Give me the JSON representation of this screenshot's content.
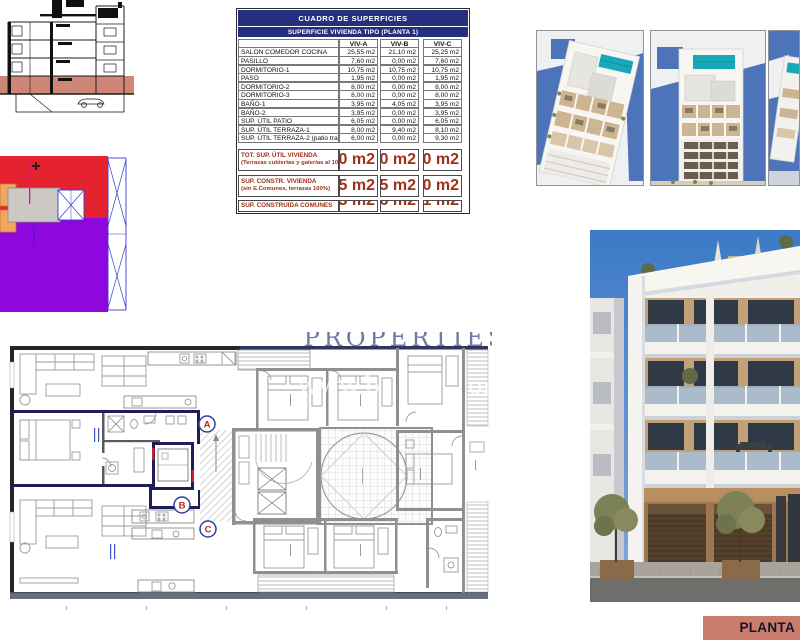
{
  "surface_table": {
    "title": "CUADRO DE SUPERFICIES",
    "subtitle": "SUPERFICIE VIVIENDA TIPO  (PLANTA 1)",
    "unit_columns": [
      "VIV-A",
      "VIV-B",
      "VIV-C"
    ],
    "rows": [
      {
        "label": "SALON COMEDOR COCINA",
        "values": [
          "25,55 m2",
          "21,10 m2",
          "25,25 m2"
        ]
      },
      {
        "label": "PASILLO",
        "values": [
          "7,60 m2",
          "0,00 m2",
          "7,60 m2"
        ]
      },
      {
        "label": "DORMITORIO-1",
        "values": [
          "10,75 m2",
          "10,75 m2",
          "10,75 m2"
        ]
      },
      {
        "label": "PASO",
        "values": [
          "1,95 m2",
          "0,00 m2",
          "1,95 m2"
        ]
      },
      {
        "label": "DORMITORIO-2",
        "values": [
          "8,00 m2",
          "0,00 m2",
          "8,00 m2"
        ]
      },
      {
        "label": "DORMITORIO-3",
        "values": [
          "8,00 m2",
          "0,00 m2",
          "8,00 m2"
        ]
      },
      {
        "label": "BAÑO-1",
        "values": [
          "3,95 m2",
          "4,05 m2",
          "3,95 m2"
        ]
      },
      {
        "label": "BAÑO-2",
        "values": [
          "3,95 m2",
          "0,00 m2",
          "3,95 m2"
        ]
      },
      {
        "label": "SUP. ÚTIL PATIO",
        "values": [
          "6,05 m2",
          "0,00 m2",
          "6,05 m2"
        ]
      },
      {
        "label": "SUP. ÚTIL TERRAZA-1",
        "values": [
          "8,00 m2",
          "9,40 m2",
          "8,10 m2"
        ]
      },
      {
        "label": "SUP. ÚTIL TERRAZA-2 (patio trasero)",
        "values": [
          "6,00 m2",
          "0,00 m2",
          "9,30 m2"
        ]
      }
    ],
    "summary_rows": [
      {
        "label": "TOT. SUP. ÚTIL VIVIENDA",
        "sublabel": "(Terrazas cubiertas y galerías al  100%)",
        "values": [
          "92,80 m2",
          "46,20 m2",
          "92,90 m2"
        ]
      },
      {
        "label": "SUP. CONSTR. VIVIENDA",
        "sublabel": "(sin E.Comunes, terrazas 100%)",
        "values": [
          "108,25 m2",
          "52,35 m2",
          "109,10 m2"
        ]
      },
      {
        "label": "SUP. CONSTRUIDA COMUNES",
        "sublabel": "",
        "values": [
          "16,33 m2",
          "8,66 m2",
          "16,31 m2"
        ]
      }
    ]
  },
  "floor_plan": {
    "watermark_top": "PROPERTIES",
    "watermark_left": "www.b",
    "watermark_right": "om",
    "markers": [
      {
        "letter": "A"
      },
      {
        "letter": "B"
      },
      {
        "letter": "C"
      }
    ]
  },
  "banner": {
    "label": "PLANTA"
  },
  "colors": {
    "header_navy": "#252f7e",
    "summary_red": "#a03018",
    "section_highlight_salmon": "#ce8677",
    "key_plan_red": "#e52330",
    "key_plan_purple": "#8d07de",
    "key_plan_orange": "#f4a55e",
    "banner_salmon": "#ca7c6d",
    "pool_teal": "#17a9b9",
    "sky_blue": "#3c7ac7",
    "highlight_navy_wall": "#1d1d5a"
  }
}
